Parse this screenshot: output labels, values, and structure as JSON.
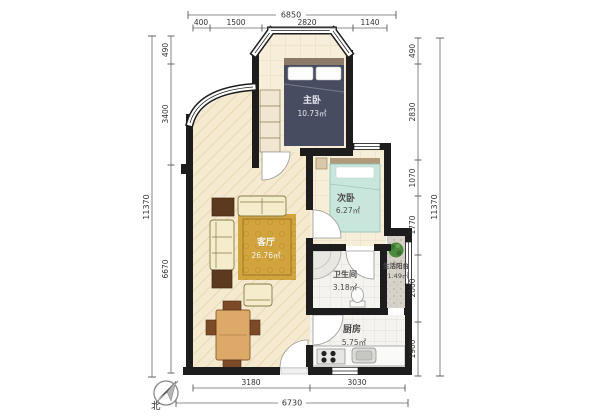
{
  "plan_title": "apartment-floor-plan",
  "rooms": {
    "master": {
      "name": "主卧",
      "area": "10.73㎡"
    },
    "second": {
      "name": "次卧",
      "area": "6.27㎡"
    },
    "living": {
      "name": "客厅",
      "area": "26.76㎡"
    },
    "bath": {
      "name": "卫生间",
      "area": "3.18㎡"
    },
    "balcony": {
      "name": "生活阳台",
      "area": "1.49㎡"
    },
    "kitchen": {
      "name": "厨房",
      "area": "5.75㎡"
    }
  },
  "dims": {
    "top": {
      "total": "6850",
      "segments": [
        "400",
        "1500",
        "2820",
        "1140"
      ]
    },
    "left": {
      "total": "11370",
      "segments": [
        "490",
        "3400",
        "6670"
      ]
    },
    "right": {
      "total": "11370",
      "segments": [
        "490",
        "2830",
        "1070",
        "1770",
        "2000",
        "1900"
      ]
    },
    "bottom": {
      "total": "6730",
      "segments": [
        "3180",
        "3030"
      ]
    }
  },
  "compass": {
    "north_label": "北"
  },
  "colors": {
    "wall": "#1d1d1d",
    "floor_living": "#f5ead0",
    "floor_bedroom": "#f7eeda",
    "floor_wet": "#f4f3ef",
    "balcony_floor": "#d6d2c9",
    "master_bed": "#474c61",
    "second_bed": "#c9e6dc",
    "rug": "#d2a43e",
    "sofa": "#f4ecca",
    "wood_dark": "#5c3a20",
    "dining_table": "#dca968",
    "plant": "#4c8a3f",
    "dim_line": "#666666"
  }
}
